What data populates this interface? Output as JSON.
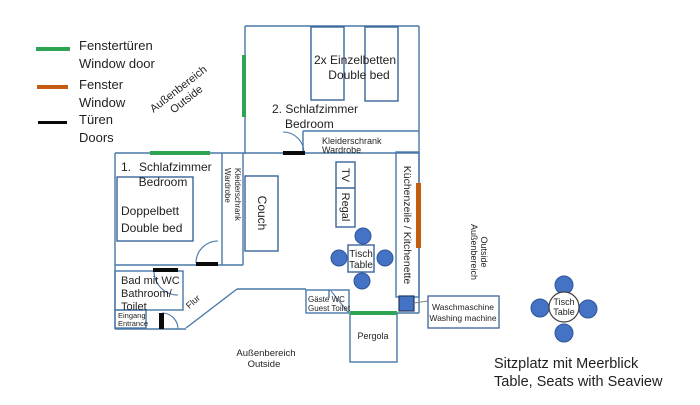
{
  "legend": {
    "items": [
      {
        "de": "Fenstertüren",
        "en": "Window door",
        "color": "#2FA452",
        "kind": "window-door"
      },
      {
        "de": "Fenster",
        "en": "Window",
        "color": "#C55A11",
        "kind": "window"
      },
      {
        "de": "Türen",
        "en": "Doors",
        "color": "#0a0a0a",
        "kind": "door"
      }
    ]
  },
  "plan": {
    "outside": {
      "de": "Außenbereich",
      "en": "Outside"
    },
    "bedroom2": {
      "name_de": "2. Schlafzimmer",
      "name_en": "Bedroom",
      "bed_de": "2x Einzelbetten",
      "bed_en": "Double bed",
      "wardrobe_de": "Kleiderschrank",
      "wardrobe_en": "Wardrobe"
    },
    "bedroom1": {
      "name_no": "1.",
      "name_de": "Schlafzimmer",
      "name_en": "Bedroom",
      "bed_de": "Doppelbett",
      "bed_en": "Double bed",
      "wardrobe_de": "Kleiderschrank",
      "wardrobe_en": "Wardrobe"
    },
    "living": {
      "couch": "Couch",
      "tv": "TV",
      "shelf": "Regal",
      "kitchen": "Küchenzeile / Kitchenette",
      "table_de": "Tisch",
      "table_en": "Table"
    },
    "bath": {
      "l1": "Bad mit WC",
      "l2": "Bathroom/",
      "l3": "Toilet"
    },
    "entrance": {
      "de": "Eingang",
      "en": "Entrance"
    },
    "hall": "Flur",
    "guest_wc": {
      "de": "Gäste WC",
      "en": "Guest Toilet"
    },
    "pergola": "Pergola",
    "washer": {
      "de": "Waschmaschine",
      "en": "Washing machine"
    },
    "outdoor_table": {
      "de": "Tisch",
      "en": "Table"
    },
    "caption": {
      "de": "Sitzplatz mit Meerblick",
      "en": "Table, Seats with Seaview"
    }
  },
  "colors": {
    "wall": "#4878A8",
    "furniture": "#3A6399",
    "seat_fill": "#4472C4",
    "seat_stroke": "#2F5597",
    "window_door_green": "#2FA452",
    "window_orange": "#C55A11",
    "door_black": "#0a0a0a"
  }
}
